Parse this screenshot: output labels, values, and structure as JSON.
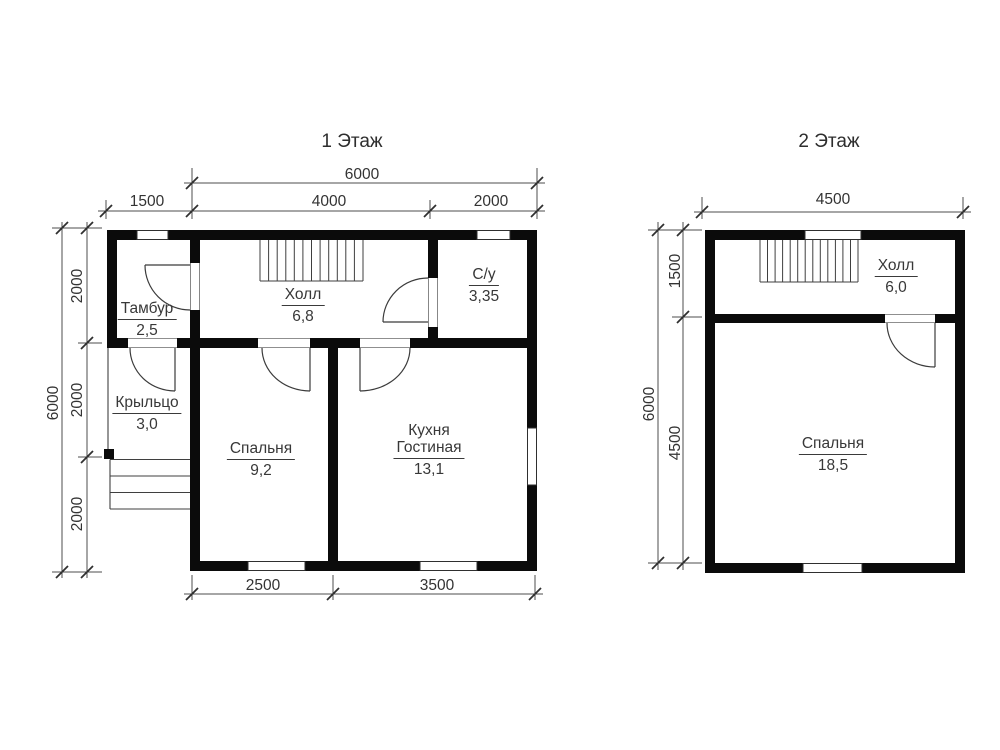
{
  "page": {
    "background": "#ffffff"
  },
  "floor1": {
    "title": "1 Этаж",
    "rooms": {
      "tambur": {
        "name": "Тамбур",
        "area": "2,5"
      },
      "hall": {
        "name": "Холл",
        "area": "6,8"
      },
      "su": {
        "name": "С/у",
        "area": "3,35"
      },
      "porch": {
        "name": "Крыльцо",
        "area": "3,0"
      },
      "bedroom": {
        "name": "Спальня",
        "area": "9,2"
      },
      "kitchen": {
        "name_line1": "Кухня",
        "name_line2": "Гостиная",
        "area": "13,1"
      }
    },
    "dimensions": {
      "top_total": "6000",
      "top_left": "1500",
      "top_mid": "4000",
      "top_right": "2000",
      "left_total": "6000",
      "left_seg1": "2000",
      "left_seg2": "2000",
      "left_seg3": "2000",
      "bottom_left": "2500",
      "bottom_right": "3500"
    }
  },
  "floor2": {
    "title": "2 Этаж",
    "rooms": {
      "hall": {
        "name": "Холл",
        "area": "6,0"
      },
      "bedroom": {
        "name": "Спальня",
        "area": "18,5"
      }
    },
    "dimensions": {
      "top_total": "4500",
      "left_total": "6000",
      "left_seg1": "1500",
      "left_seg2": "4500"
    }
  }
}
